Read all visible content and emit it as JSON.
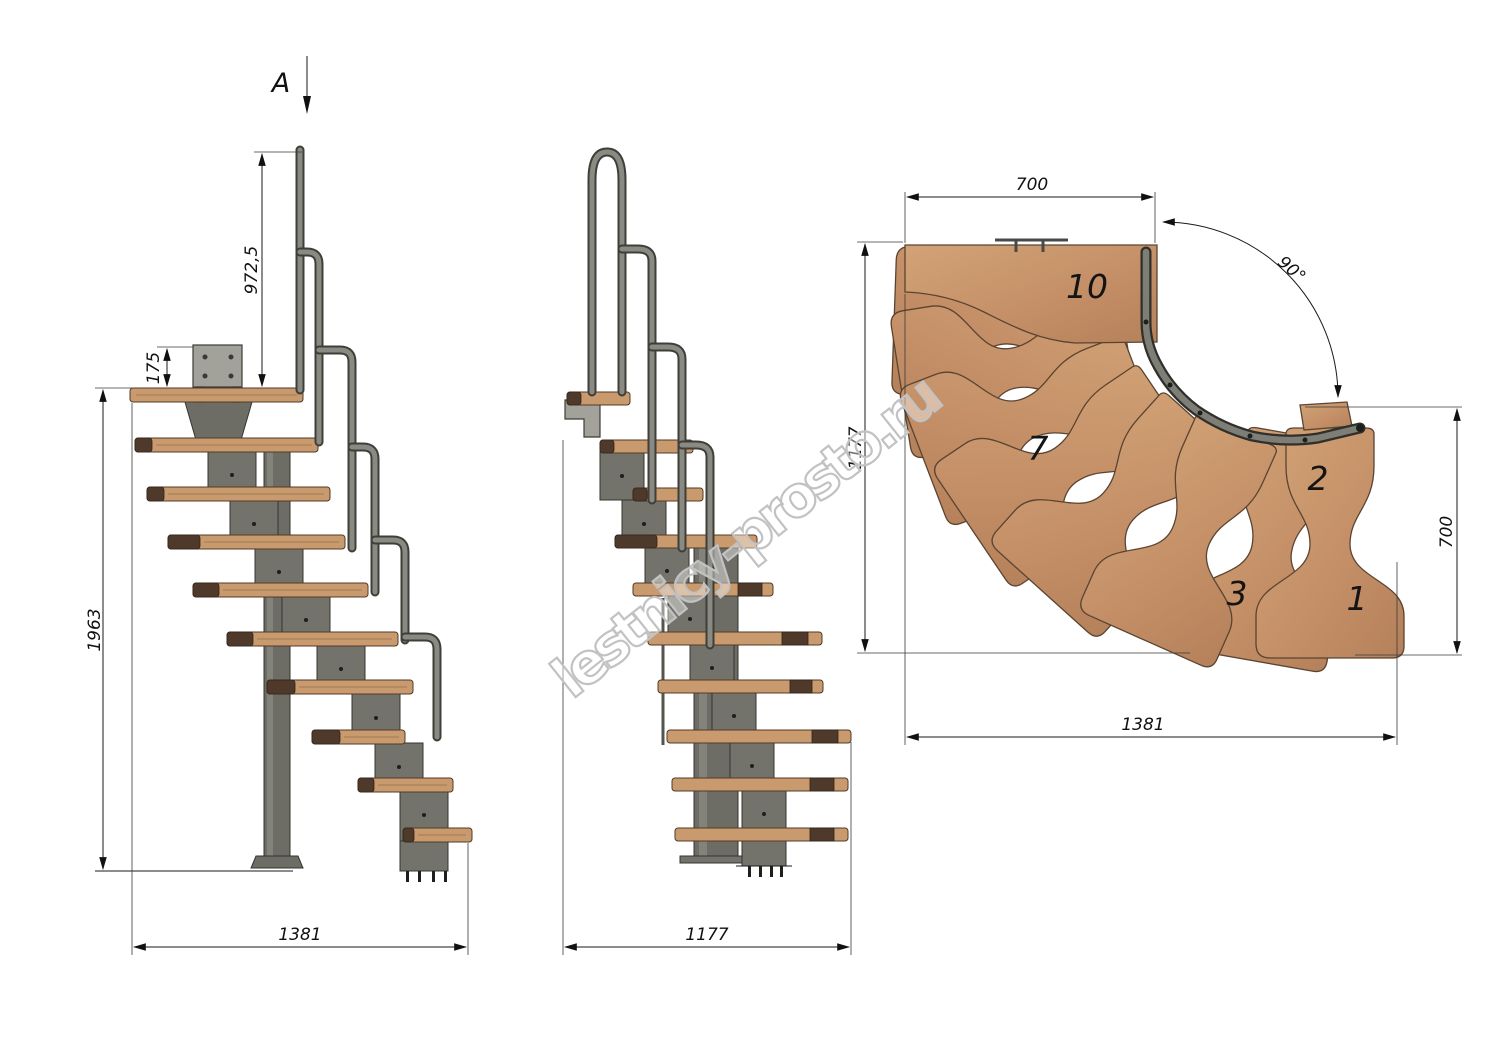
{
  "drawing": {
    "watermark": "lestnicy-prosto.ru",
    "section_marker": "A",
    "side_view": {
      "dim_handrail_height": "972,5",
      "dim_bracket_height": "175",
      "dim_total_height": "1963",
      "dim_length": "1381"
    },
    "front_view": {
      "dim_width": "1177"
    },
    "plan_view": {
      "dim_top_width": "700",
      "dim_turn_angle": "90°",
      "dim_left_depth": "1177",
      "dim_right_width": "700",
      "dim_bottom_length": "1381",
      "tread_labels": {
        "landing": "10",
        "seventh": "7",
        "second": "2",
        "third": "3",
        "first": "1"
      }
    },
    "colors": {
      "wood_light": "#d2a376",
      "wood_mid": "#c08a5e",
      "wood_edge_dark": "#4e392a",
      "metal_light": "#9a9a94",
      "metal_mid": "#73736c",
      "metal_dark": "#3c3c37",
      "dimension_line": "#1a1a1a",
      "watermark_gray": "#c2c2c2"
    }
  }
}
